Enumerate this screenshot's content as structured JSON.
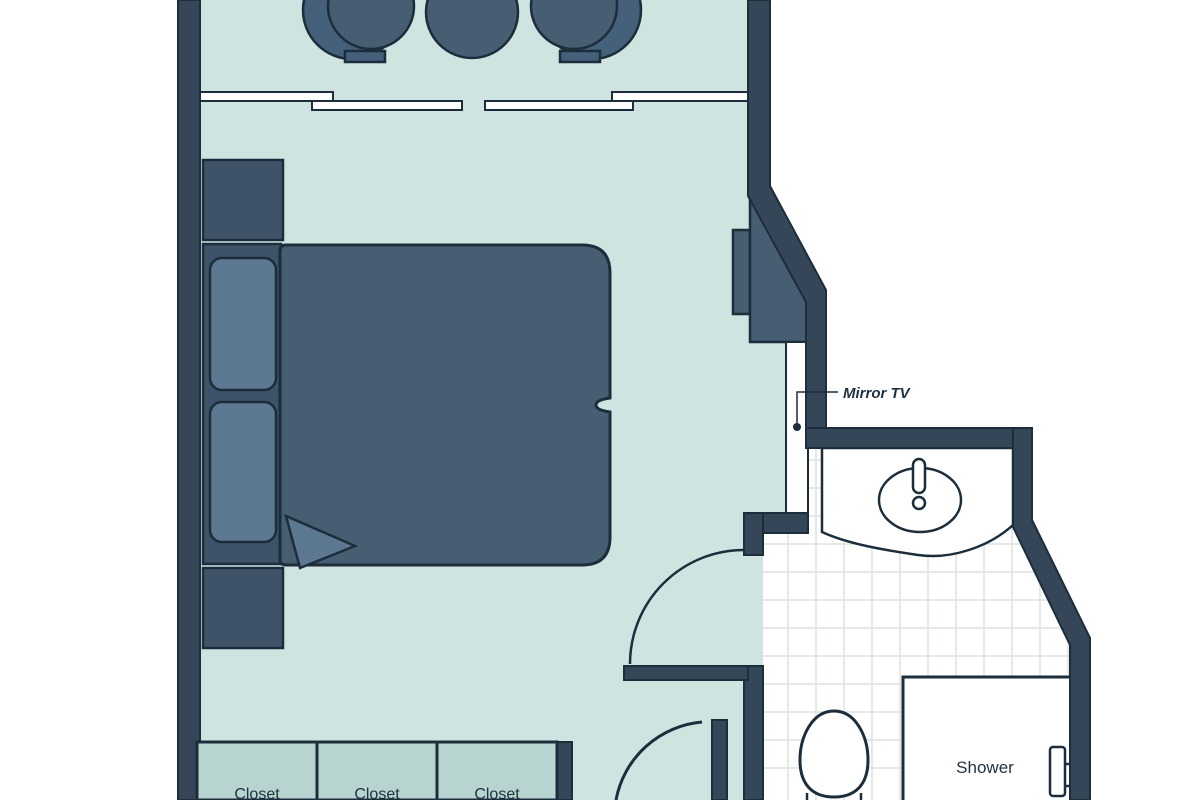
{
  "floorplan": {
    "labels": {
      "mirror_tv": "Mirror TV",
      "shower": "Shower",
      "closets": {
        "0": "Closet",
        "1": "Closet",
        "2": "Closet"
      }
    },
    "colors": {
      "room_fill": "#cfe4e1",
      "closet_fill": "#b7d4d0",
      "wall_fill": "#344658",
      "outline": "#1c2d3b",
      "furniture": "#475d72",
      "furniture_dark": "#3e5268",
      "furniture_light": "#5d7891",
      "tile_line": "#dfe1e1",
      "fixture_fill": "#ffffff"
    }
  }
}
